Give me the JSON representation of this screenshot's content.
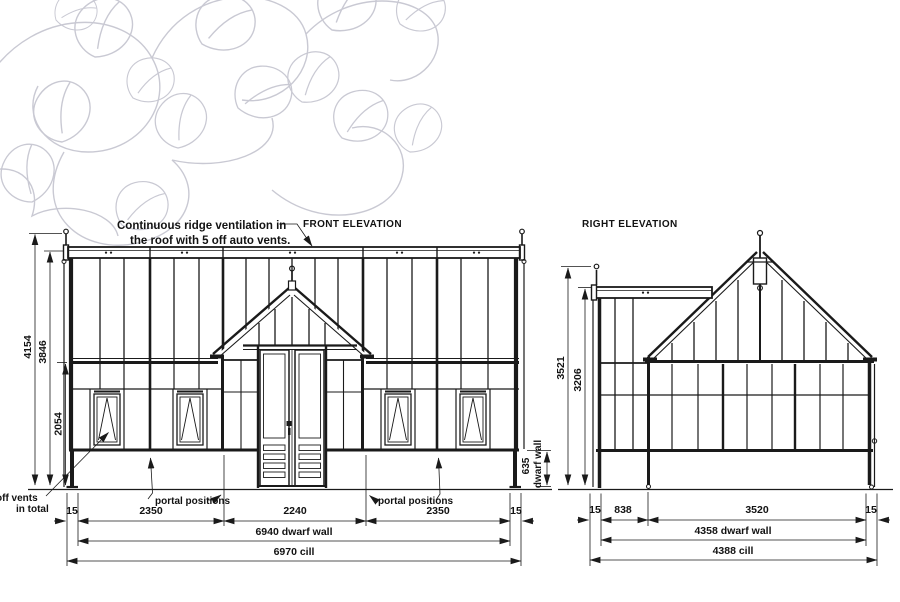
{
  "annotation": {
    "line1": "Continuous ridge ventilation in",
    "line2": "the roof with 5 off auto vents."
  },
  "front_elevation": {
    "title": "FRONT ELEVATION",
    "dim_total_height": "4154",
    "dim_ridge_height": "3846",
    "dim_eaves_height": "2054",
    "dim_dwarf_height_value": "635",
    "dim_dwarf_height_label": "dwarf wall",
    "dim_left_offset": "15",
    "dim_bay_left": "2350",
    "dim_center": "2240",
    "dim_bay_right": "2350",
    "dim_right_offset": "15",
    "dim_dwarf_wall": "6940 dwarf wall",
    "dim_cill": "6970 cill",
    "label_portal_left": "portal positions",
    "label_portal_right": "portal positions",
    "label_vents_line1": "off vents",
    "label_vents_line2": "in total"
  },
  "right_elevation": {
    "title": "RIGHT ELEVATION",
    "dim_total_height": "3521",
    "dim_ridge_height": "3206",
    "dim_left_offset": "15",
    "dim_porch_depth": "838",
    "dim_main_depth": "3520",
    "dim_right_offset": "15",
    "dim_dwarf_wall": "4358 dwarf wall",
    "dim_cill": "4388 cill"
  },
  "colors": {
    "line": "#1a1a1a",
    "leaf": "#c9c9d3"
  }
}
